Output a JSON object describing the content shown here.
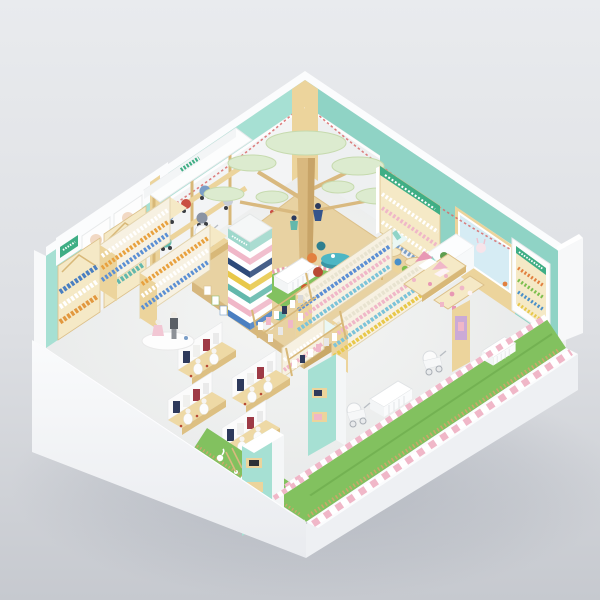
{
  "meta": {
    "title": "Isometric 3D render of a children's / mother-and-baby retail store interior",
    "render_style": "cutaway isometric room on neutral grey studio background",
    "note": "signage characters are only a few pixels tall; readings are approximate"
  },
  "palette": {
    "bg1": "#e9ebee",
    "bg2": "#c6c9cf",
    "wall": "#f3f4f5",
    "rim": "#fbfcfd",
    "outer": "#eff1f4",
    "mint": "#a6e0d3",
    "mintd": "#8fd3c5",
    "wood": "#ecd49c",
    "woodd": "#d8b878",
    "woodl": "#f5e9c6",
    "floor": "#ecedee",
    "grass": "#82c15f",
    "fence": "#caa86a",
    "pink": "#f0b7c8",
    "pinkd": "#e898b4",
    "sign": "#3fae85",
    "bunting": "#d86a6a",
    "poster_blue": "#d6ecf4",
    "table_teal": "#4db6c4",
    "navy": "#2e4a7a",
    "blue": "#4a7fc1",
    "yellow": "#e8c84a",
    "orange": "#e2803f",
    "rust": "#b84a35",
    "teal": "#63b8ac",
    "canopy": "#dcebcf",
    "trunk": "#d9b97f",
    "screen": "#2e3136"
  },
  "signs": {
    "milk_powder": {
      "text": "奶粉区",
      "style": "green characters on white header above formula shelves"
    },
    "stroller": {
      "text": "童车区",
      "style": "green characters on white awning"
    },
    "shoes": {
      "text": "童鞋区",
      "style": "white characters on green board atop wall shelf"
    },
    "toys": {
      "text": "玩具区",
      "style": "white characters on green board atop arched wall shelf"
    }
  },
  "tower": {
    "label": "striped brand tower column",
    "stripes": [
      {
        "c": "#9fd8cc",
        "h": 10
      },
      {
        "c": "#ffffff",
        "h": 6.5
      },
      {
        "c": "#f0b7c8",
        "h": 6.5
      },
      {
        "c": "#ffffff",
        "h": 6.5
      },
      {
        "c": "#2e4a7a",
        "h": 6.5
      },
      {
        "c": "#ffffff",
        "h": 6.5
      },
      {
        "c": "#e8c84a",
        "h": 6.5
      },
      {
        "c": "#ffffff",
        "h": 6.5
      },
      {
        "c": "#63b8ac",
        "h": 6.5
      },
      {
        "c": "#ffffff",
        "h": 6.5
      },
      {
        "c": "#f0b7c8",
        "h": 6.5
      },
      {
        "c": "#ffffff",
        "h": 6.5
      },
      {
        "c": "#4a7fc1",
        "h": 6.5
      }
    ]
  },
  "areas": [
    {
      "name": "play-area",
      "desc": "raised wooden platform, stylized tree with pale-green disc canopies, grass ring with mini fence, two child figures, white kids table with chairs, colorful hexagon stools, letter blocks"
    },
    {
      "name": "stroller-zone",
      "desc": "two-tier wooden display bay under white awning, blue / red / teal prams"
    },
    {
      "name": "milk-powder-zone",
      "desc": "gable-top wooden shelves of formula cans, baby-face posters on header"
    },
    {
      "name": "shoe-zone",
      "desc": "wooden wall shelf with rows of children's shoes"
    },
    {
      "name": "toy-zone",
      "desc": "arched wooden wall shelf with toys"
    },
    {
      "name": "wall-poster",
      "desc": "large pale-blue board with bunny illustration on wooden wall panel"
    },
    {
      "name": "checkout-counter",
      "desc": "white reception counter with small green plant"
    },
    {
      "name": "product-aisles",
      "desc": "wooden gondola shelves with bottles and pastel goods, scalloped teal canopy tops"
    },
    {
      "name": "dollhouse-display",
      "desc": "pink dollhouse toy tables"
    },
    {
      "name": "reading-corner",
      "desc": "round teal table with orange / rust / blue poufs, small wooden tables with colored stools"
    },
    {
      "name": "clothing-display",
      "desc": "four wooden tables with white baby mannequins and hanging garments; adult and child mannequin on round white podium"
    },
    {
      "name": "nursery-zone",
      "desc": "white cribs and prams on green turf strip behind pink-striped railing"
    },
    {
      "name": "tea-party-corner",
      "desc": "tiny white chairs and tables on turf inside front-left corner, wooden ladder, white swan toy"
    },
    {
      "name": "decor",
      "desc": "mint wall bands with glowing light strips, red bunting garlands, pink-and-white striped half walls"
    }
  ]
}
